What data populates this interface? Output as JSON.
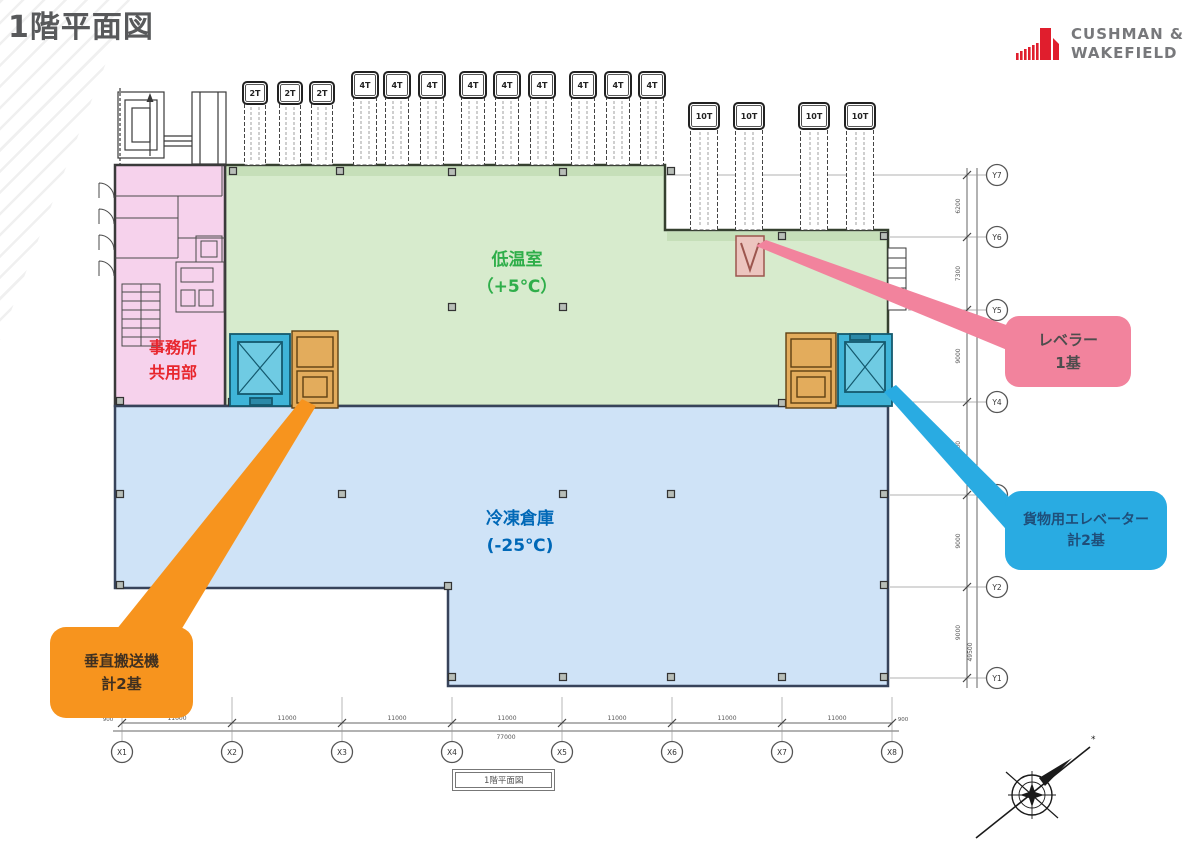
{
  "header": {
    "title": "1階平面図"
  },
  "logo": {
    "line1": "CUSHMAN &",
    "line2": "WAKEFIELD",
    "red": "#e01e2d",
    "gray": "#77787b"
  },
  "zones": {
    "office": {
      "lines": [
        "事務所",
        "共用部"
      ],
      "fill": "#f6d2ec",
      "text": "#e8262d"
    },
    "chill": {
      "lines": [
        "低温室",
        "（+5℃）"
      ],
      "fill": "#d7ebcd",
      "text": "#2fae4a"
    },
    "freezer": {
      "lines": [
        "冷凍倉庫",
        "(-25℃)"
      ],
      "fill": "#cfe3f7",
      "text": "#0068b7"
    }
  },
  "callouts": {
    "leveler": {
      "lines": [
        "レベラー",
        "1基"
      ],
      "fill": "#f2839d",
      "text": "#4d4d4d"
    },
    "cargo": {
      "lines": [
        "貨物用エレベーター",
        "計2基"
      ],
      "fill": "#29abe2",
      "text": "#1f4e79"
    },
    "conveyor": {
      "lines": [
        "垂直搬送機",
        "計2基"
      ],
      "fill": "#f7941e",
      "text": "#403020"
    }
  },
  "equipment": {
    "leveler_fill": "#ecc5bf",
    "elevator_fill": "#3fb4d8",
    "elevator_inner": "#6fcbe3",
    "conveyor_fill": "#e3ac5c"
  },
  "trucks": [
    {
      "label": "2T",
      "xs": [
        243,
        278,
        310
      ],
      "w": 24,
      "cab_y": 82,
      "cab_h": 22,
      "bottom": 165
    },
    {
      "label": "4T",
      "xs": [
        352,
        384,
        419,
        460,
        494,
        529,
        570,
        605,
        639
      ],
      "w": 26,
      "cab_y": 72,
      "cab_h": 26,
      "bottom": 165
    },
    {
      "label": "10T",
      "xs": [
        689,
        734,
        799,
        845
      ],
      "w": 30,
      "cab_y": 103,
      "cab_h": 26,
      "bottom": 230
    }
  ],
  "x_axis": {
    "ticks": [
      "X1",
      "X2",
      "X3",
      "X4",
      "X5",
      "X6",
      "X7",
      "X8"
    ],
    "positions": [
      122,
      232,
      342,
      452,
      562,
      672,
      782,
      892
    ],
    "spans": [
      "11000",
      "11000",
      "11000",
      "11000",
      "11000",
      "11000",
      "11000"
    ],
    "total": "77000",
    "edge_left": "900",
    "edge_right": "900"
  },
  "y_axis": {
    "ticks": [
      "Y7",
      "Y6",
      "Y5",
      "Y4",
      "Y3",
      "Y2",
      "Y1"
    ],
    "positions": [
      175,
      237,
      310,
      402,
      495,
      587,
      678
    ],
    "spans": [
      "6200",
      "7300",
      "9000",
      "9000",
      "9000",
      "9000"
    ],
    "total": "49500"
  },
  "caption": "1階平面図",
  "column_markers": [
    [
      233,
      171
    ],
    [
      340,
      171
    ],
    [
      452,
      172
    ],
    [
      563,
      172
    ],
    [
      671,
      171
    ],
    [
      782,
      236
    ],
    [
      884,
      236
    ],
    [
      452,
      307
    ],
    [
      563,
      307
    ],
    [
      120,
      401
    ],
    [
      232,
      402
    ],
    [
      782,
      403
    ],
    [
      120,
      494
    ],
    [
      342,
      494
    ],
    [
      563,
      494
    ],
    [
      671,
      494
    ],
    [
      884,
      494
    ],
    [
      120,
      585
    ],
    [
      448,
      586
    ],
    [
      884,
      585
    ],
    [
      452,
      677
    ],
    [
      563,
      677
    ],
    [
      671,
      677
    ],
    [
      782,
      677
    ],
    [
      884,
      677
    ]
  ]
}
